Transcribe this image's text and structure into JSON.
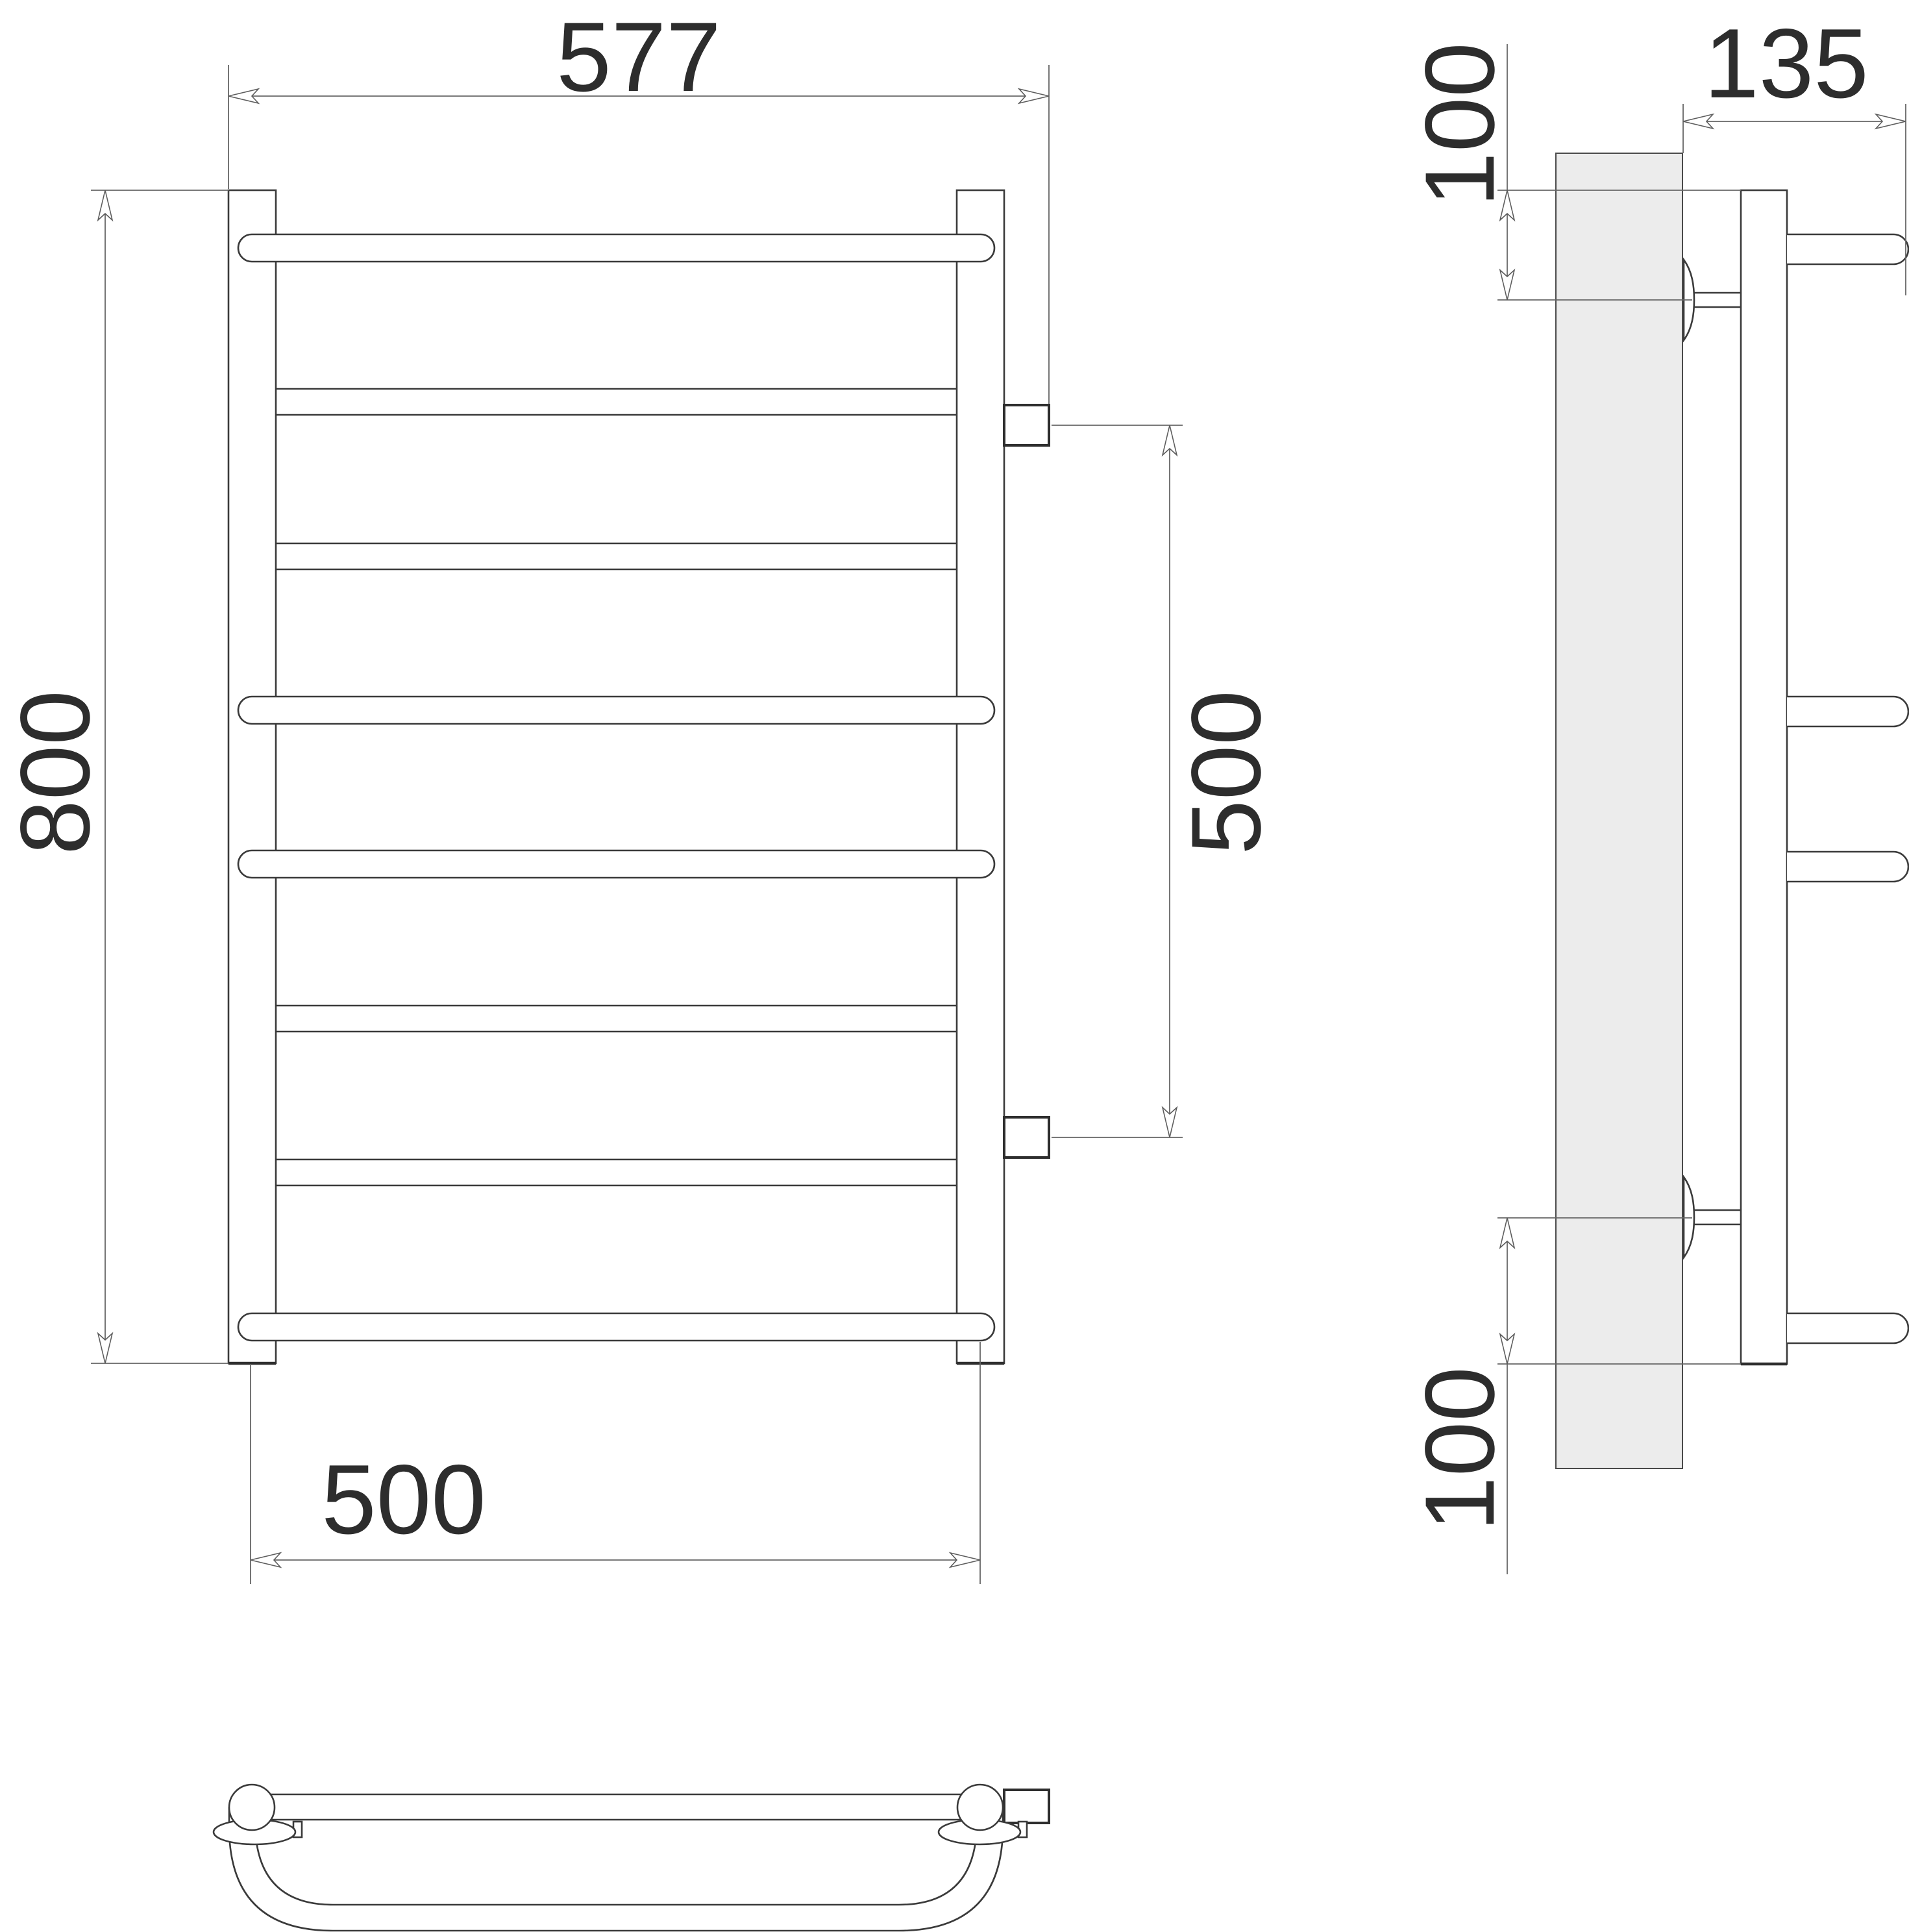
{
  "drawing": {
    "kind": "technical-drawing-three-views-towel-rail",
    "colors": {
      "outline": "#3a3a3a",
      "dimension_lines": "#666666",
      "text": "#2d2d2d",
      "wall_fill": "#ececec",
      "background": "#ffffff"
    },
    "front_view": {
      "width_overall": "577",
      "height_overall": "800",
      "bar_length": "500",
      "connection_spacing": "500"
    },
    "side_view": {
      "depth": "135",
      "top_bracket_offset": "100",
      "bottom_bracket_offset": "100"
    }
  }
}
